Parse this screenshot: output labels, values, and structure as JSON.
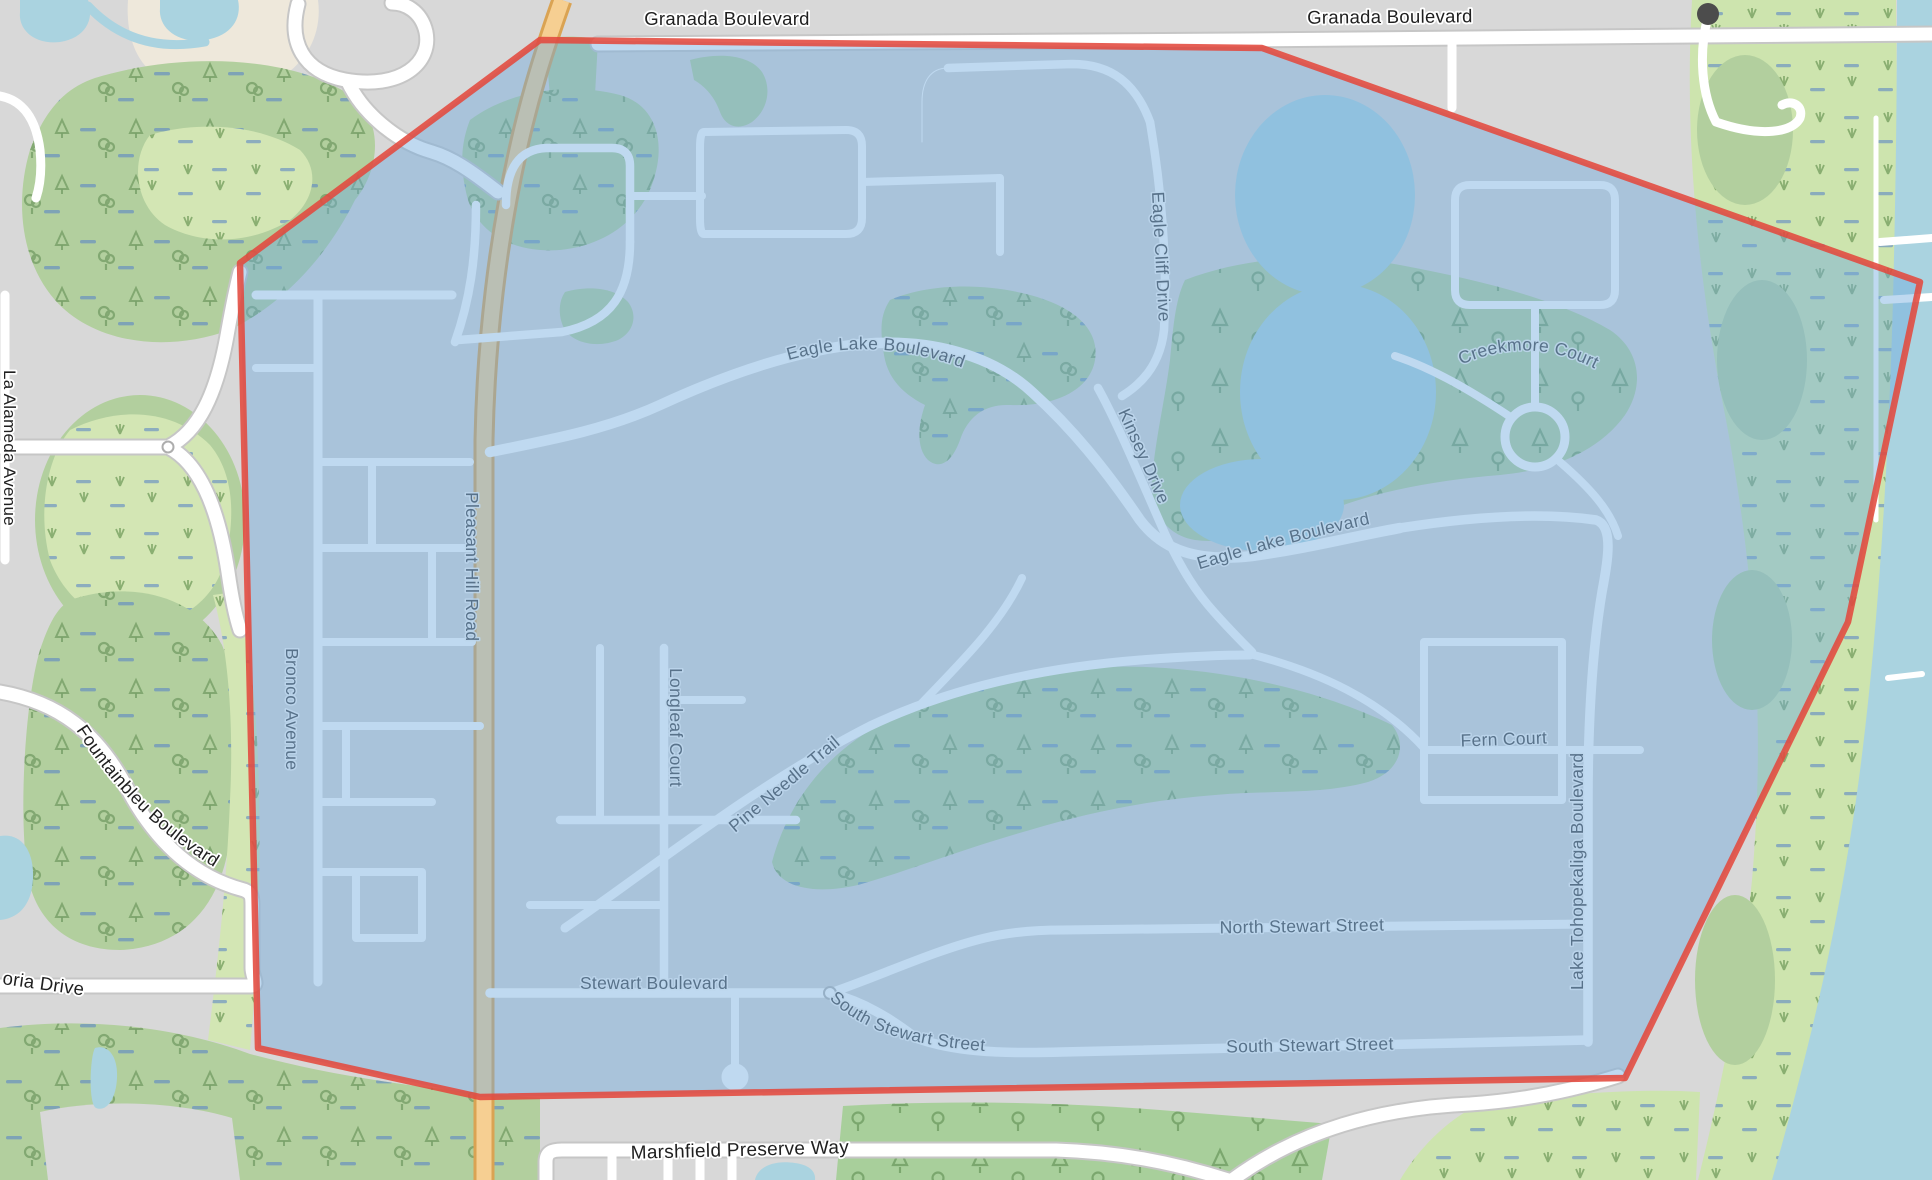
{
  "map": {
    "type": "street-map-with-highlighted-region",
    "marker_dot": {
      "color": "#4c4c4c"
    },
    "region": {
      "boundary_color": "#E2493D",
      "fill_color": "#71ABDE",
      "fill_opacity": "0.45"
    },
    "labels": {
      "granada_blvd_1": "Granada Boulevard",
      "granada_blvd_2": "Granada Boulevard",
      "eagle_lake_blvd_1": "Eagle Lake Boulevard",
      "eagle_lake_blvd_2": "Eagle Lake Boulevard",
      "eagle_cliff_drive": "Eagle Cliff Drive",
      "kinsey_drive": "Kinsey Drive",
      "creekmore_court": "Creekmore Court",
      "pleasant_hill_road": "Pleasant Hill Road",
      "bronco_avenue": "Bronco Avenue",
      "longleaf_court": "Longleaf Court",
      "pine_needle_trail": "Pine Needle Trail",
      "fern_court": "Fern Court",
      "lake_tohopekaliga_blvd": "Lake Tohopekaliga Boulevard",
      "north_stewart_street": "North Stewart Street",
      "stewart_boulevard": "Stewart Boulevard",
      "south_stewart_street_1": "South Stewart Street",
      "south_stewart_street_2": "South Stewart Street",
      "marshfield_preserve_way": "Marshfield Preserve Way",
      "fountainbleu_boulevard": "Fountainbleu Boulevard",
      "la_alameda_avenue": "La Alameda Avenue",
      "victoria_drive_partial": "oria Drive"
    }
  }
}
